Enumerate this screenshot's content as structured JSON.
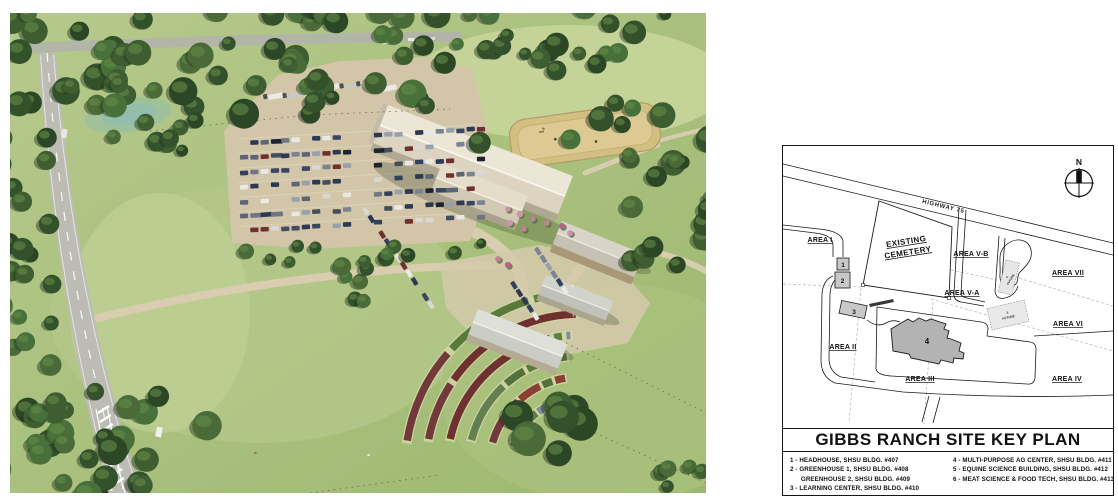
{
  "aerial_photo": {
    "alt": "Aerial rendering of Gibbs Ranch campus with parking lot, multi-purpose ag center, arena, greenhouses and garden beds",
    "colors": {
      "grass": "#aec57f",
      "trees": "#3b5a2e",
      "road": "#bcbcb4",
      "parking": "#d2c5a8",
      "building_roof": "#ece6d6",
      "arena": "#d6c286"
    }
  },
  "site_plan": {
    "title": "GIBBS RANCH SITE KEY PLAN",
    "compass_north_label": "N",
    "highway_label": "HIGHWAY 75",
    "cemetery_line1": "EXISTING",
    "cemetery_line2": "CEMETERY",
    "area_labels": {
      "area_i": "AREA I",
      "area_ii": "AREA II",
      "area_iii": "AREA III",
      "area_iv": "AREA IV",
      "area_v_a": "AREA V-A",
      "area_v_b": "AREA V-B",
      "area_vi": "AREA VI",
      "area_vii": "AREA VII"
    },
    "building_markers": {
      "b1": "1",
      "b2": "2",
      "b3": "3",
      "b4": "4"
    },
    "future_markers": {
      "f6_num": "6",
      "f6_label": "FUTURE",
      "f5_num": "5",
      "f5_label": "FUTURE"
    },
    "legend": {
      "left": [
        "1 - HEADHOUSE, SHSU BLDG. #407",
        "2 - GREENHOUSE 1, SHSU BLDG. #408",
        "      GREENHOUSE 2, SHSU BLDG. #409",
        "3 - LEARNING CENTER, SHSU BLDG. #410"
      ],
      "right": [
        "4 - MULTI-PURPOSE AG CENTER, SHSU BLDG. #411",
        "5 - EQUINE SCIENCE BUILDING, SHSU BLDG. #412",
        "6 - MEAT SCIENCE & FOOD TECH, SHSU BLDG. #413"
      ]
    }
  }
}
